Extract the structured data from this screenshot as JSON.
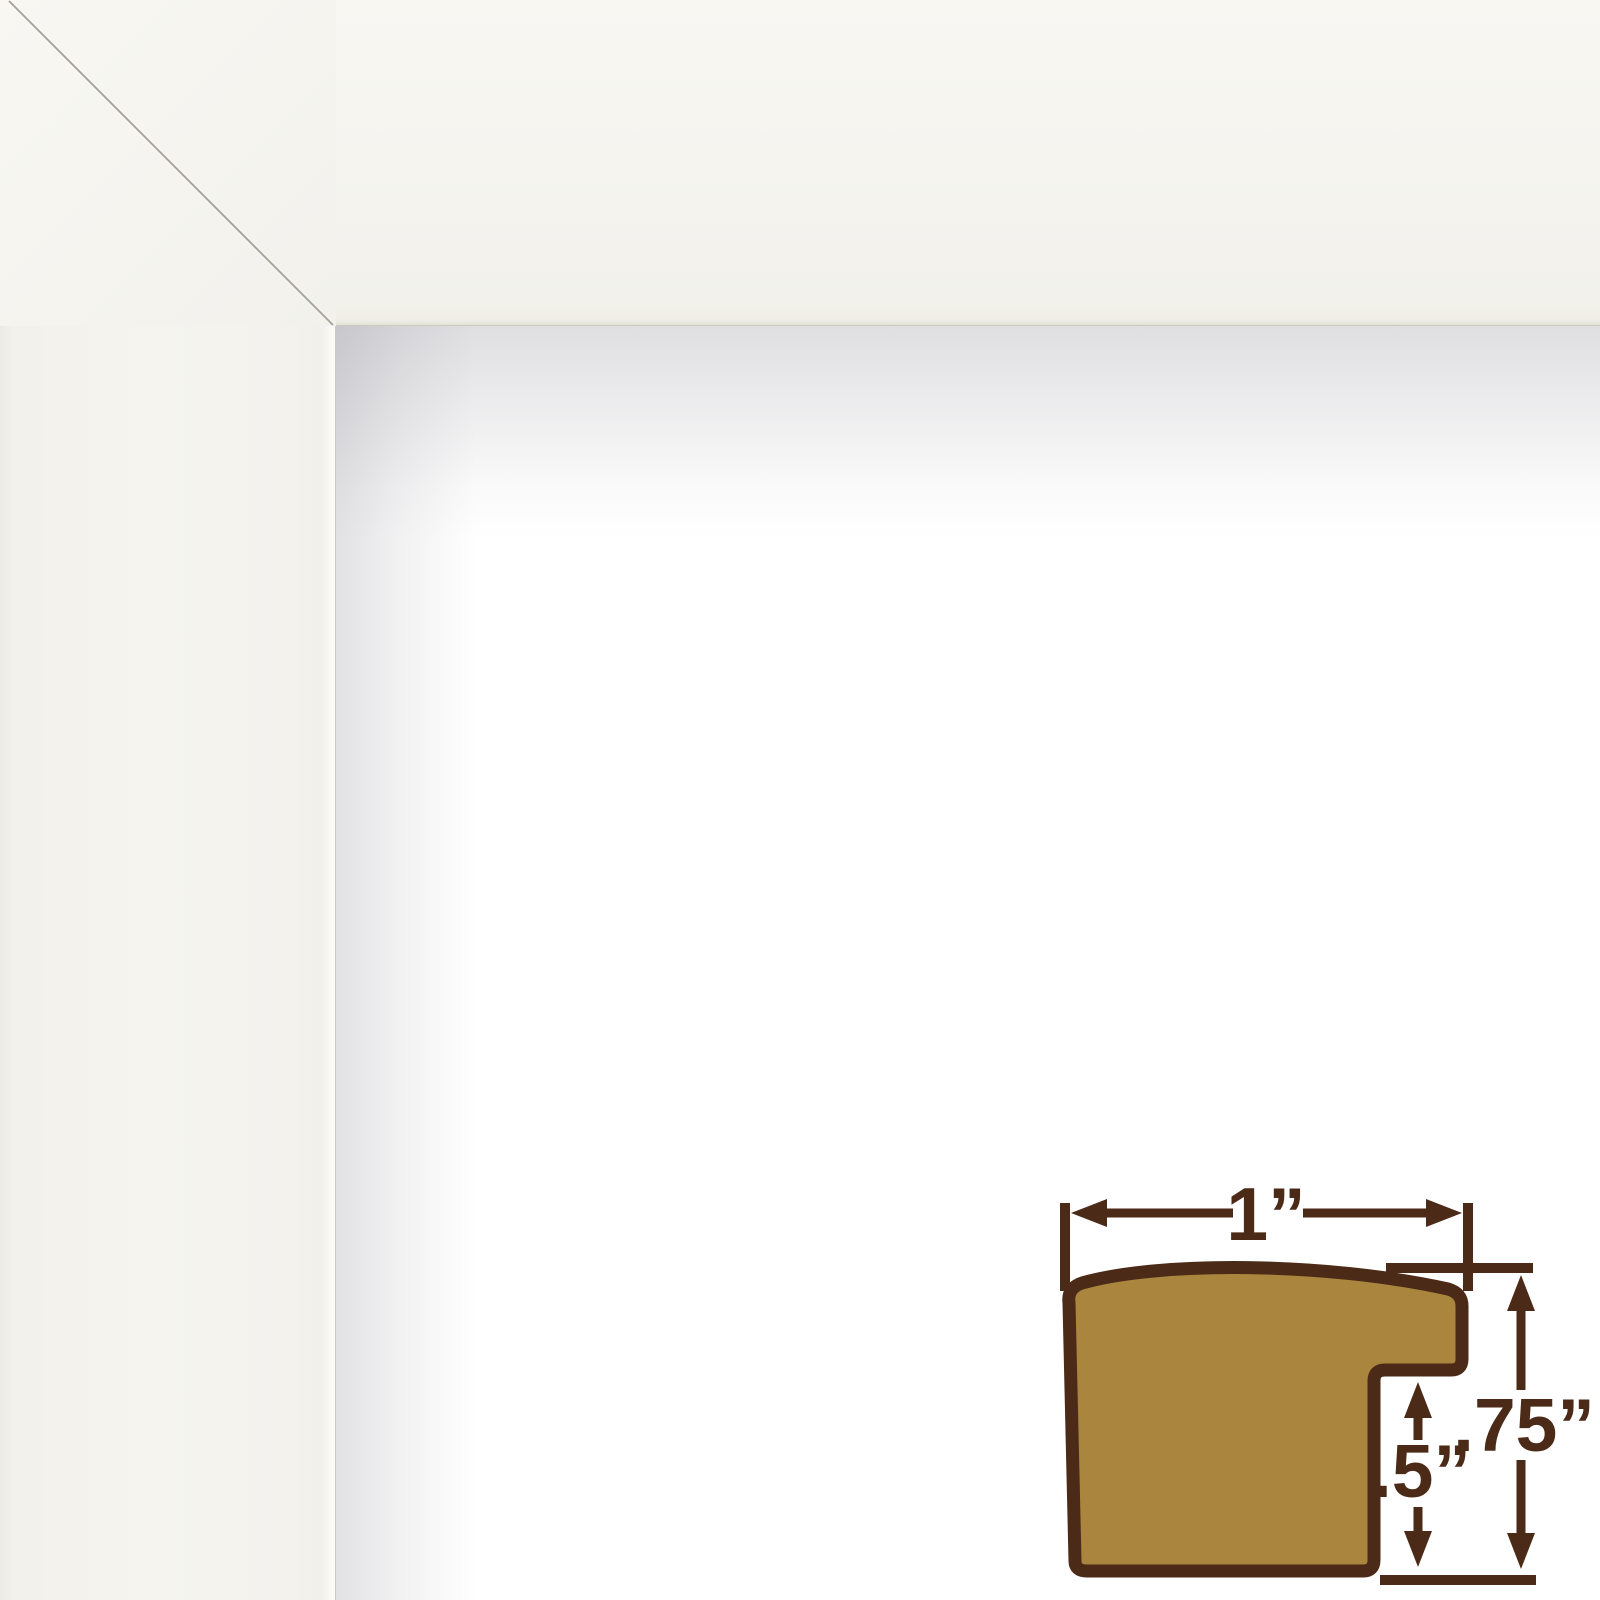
{
  "colors": {
    "frame_face": "#f5f4ef",
    "miter_line": "#a39f96",
    "diagram_fill": "#a9853e",
    "diagram_line": "#4b2a17"
  },
  "frame_sample": {
    "finish": "white"
  },
  "profile_diagram": {
    "width_label": "1”",
    "rabbet_label": ".5”",
    "height_label": ".75”"
  }
}
